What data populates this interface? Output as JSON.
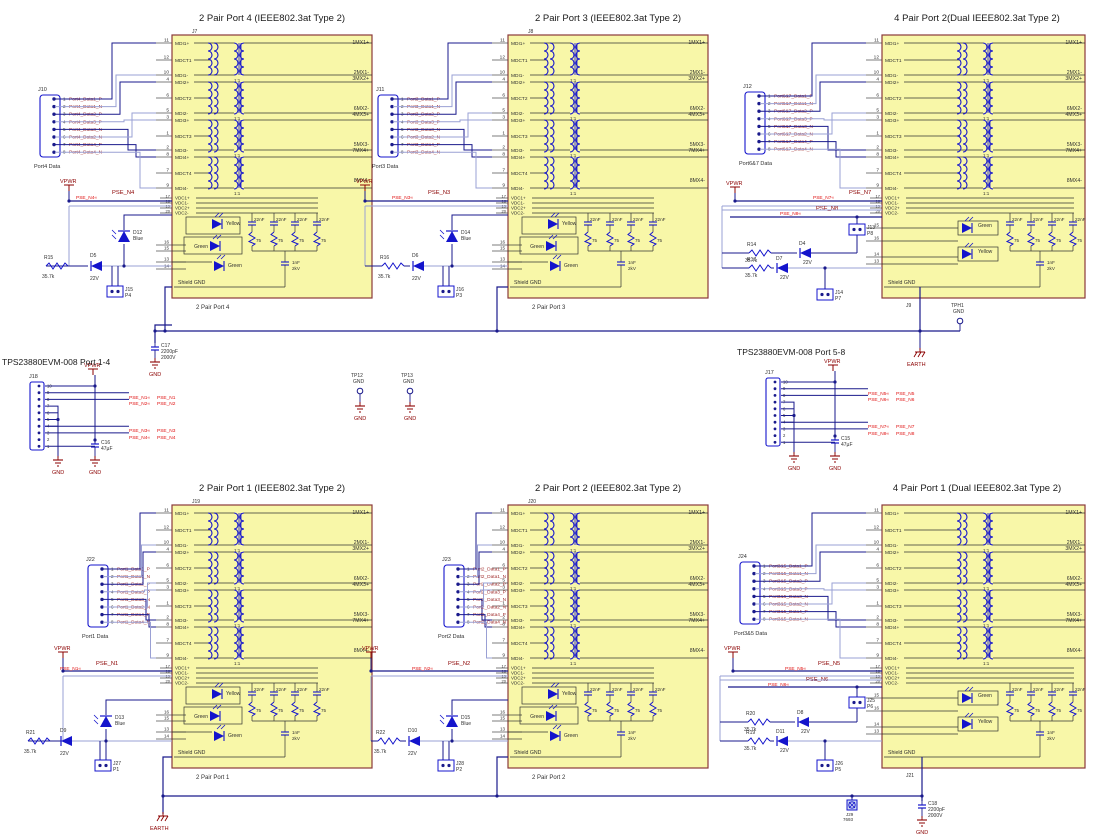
{
  "canvas": {
    "w": 1097,
    "h": 840
  },
  "colors": {
    "block_fill": "#F8F7A8",
    "block_border": "#8B3A3A",
    "wire": "#1A1A8C",
    "wire_light": "#9AA0D4",
    "component": "#1414CC",
    "net_label": "#8B0000",
    "net_flag": "#E01010",
    "text": "#303030",
    "conn_net": "#A33333",
    "power": "#8B0000"
  },
  "shared_block": {
    "pins_left": [
      [
        "11",
        "MDI1+"
      ],
      [
        "12",
        "MDCT1"
      ],
      [
        "10",
        "MDI1-"
      ],
      [
        "4",
        "MDI2+"
      ],
      [
        "6",
        "MDCT2"
      ],
      [
        "5",
        "MDI2-"
      ],
      [
        "3",
        "MDI3+"
      ],
      [
        "1",
        "MDCT3"
      ],
      [
        "2",
        "MDI3-"
      ],
      [
        "8",
        "MDI4+"
      ],
      [
        "7",
        "MDCT4"
      ],
      [
        "9",
        "MDI4-"
      ]
    ],
    "pins_vdc": [
      [
        "17",
        "VDC1+"
      ],
      [
        "18",
        "VDC1-"
      ],
      [
        "19",
        "VDC2+"
      ],
      [
        "20",
        "VDC2-"
      ]
    ],
    "pins_led_2pair": [
      "16",
      "15",
      "13",
      "14"
    ],
    "pins_led_4pair": [
      "15",
      "16",
      "14",
      "13"
    ],
    "labels_right": [
      "1MX1+",
      "2MX1-",
      "3MX2+",
      "6MX2-",
      "4MX3+",
      "5MX3-",
      "7MX4+",
      "8MX4-"
    ],
    "ratio": "1:1",
    "cap_value": "22nF",
    "res_value": "75",
    "hv_cap": [
      "1nF",
      "2kV"
    ],
    "shield": "Shield GND"
  },
  "blocks": [
    {
      "ref": "J7",
      "ref_pos": "top",
      "title": "2 Pair Port 4 (IEEE802.3at Type 2)",
      "caption": "2 Pair Port 4",
      "type": "2pair",
      "x": 172,
      "y": 35,
      "leds": [
        "Yellow",
        "Green",
        "Green"
      ],
      "connector": {
        "ref": "J10",
        "label": "Port4 Data",
        "x": 40,
        "y": 95,
        "pins": [
          "1",
          "2",
          "3",
          "4",
          "5",
          "6",
          "7",
          "8"
        ],
        "nets": [
          "Port4_Data1_P",
          "Port4_Data1_N",
          "Port4_Data2_P",
          "Port4_Data3_P",
          "Port4_Data3_N",
          "Port4_Data2_N",
          "Port4_Data4_P",
          "Port4_Data4_N"
        ]
      },
      "vpwr": {
        "label": "VPWR",
        "x": 60,
        "y": 178
      },
      "pse": [
        {
          "name": "PSE_N4",
          "fx": 76,
          "fy": 199,
          "lx": 112,
          "ly": 194
        }
      ],
      "ext": [
        {
          "kind": "res",
          "ref": "R15",
          "val": "35.7k",
          "x": 46,
          "y": 266
        },
        {
          "kind": "zener",
          "ref": "D5",
          "val": "22V",
          "x": 88,
          "y": 266
        },
        {
          "kind": "bled",
          "ref": "D12",
          "val": "Blue",
          "x": 118,
          "y": 228
        },
        {
          "kind": "hdr",
          "ref": "J15",
          "val": "P4",
          "x": 107,
          "y": 286
        }
      ]
    },
    {
      "ref": "J8",
      "ref_pos": "top",
      "title": "2 Pair Port 3 (IEEE802.3at Type 2)",
      "caption": "2 Pair Port 3",
      "type": "2pair",
      "x": 508,
      "y": 35,
      "leds": [
        "Yellow",
        "Green",
        "Green"
      ],
      "connector": {
        "ref": "J11",
        "label": "Port3 Data",
        "x": 378,
        "y": 95,
        "pins": [
          "1",
          "2",
          "3",
          "4",
          "5",
          "6",
          "7",
          "8"
        ],
        "nets": [
          "Port3_Data1_P",
          "Port3_Data1_N",
          "Port3_Data2_P",
          "Port3_Data3_P",
          "Port3_Data3_N",
          "Port3_Data2_N",
          "Port3_Data4_P",
          "Port3_Data4_N"
        ]
      },
      "vpwr": {
        "label": "VPWR",
        "x": 356,
        "y": 178
      },
      "pse": [
        {
          "name": "PSE_N3",
          "fx": 392,
          "fy": 199,
          "lx": 428,
          "ly": 194
        }
      ],
      "ext": [
        {
          "kind": "res",
          "ref": "R16",
          "val": "35.7k",
          "x": 382,
          "y": 266
        },
        {
          "kind": "zener",
          "ref": "D6",
          "val": "22V",
          "x": 410,
          "y": 266
        },
        {
          "kind": "bled",
          "ref": "D14",
          "val": "Blue",
          "x": 446,
          "y": 228
        },
        {
          "kind": "hdr",
          "ref": "J16",
          "val": "P3",
          "x": 438,
          "y": 286
        }
      ]
    },
    {
      "ref": "J9",
      "ref_pos": "bottom",
      "title": "4 Pair Port 2(Dual IEEE802.3at Type 2)",
      "caption": "",
      "type": "4pair",
      "x": 882,
      "y": 35,
      "leds": [
        "Green",
        "Yellow"
      ],
      "connector": {
        "ref": "J12",
        "label": "Port6&7 Data",
        "x": 745,
        "y": 92,
        "pins": [
          "1",
          "2",
          "3",
          "4",
          "5",
          "6",
          "7",
          "8"
        ],
        "nets": [
          "Port6&7_Data1_P",
          "Port6&7_Data1_N",
          "Port6&7_Data2_P",
          "Port6&7_Data3_P",
          "Port6&7_Data3_N",
          "Port6&7_Data2_N",
          "Port6&7_Data4_P",
          "Port6&7_Data4_N"
        ]
      },
      "vpwr": {
        "label": "VPWR",
        "x": 726,
        "y": 180
      },
      "pse": [
        {
          "name": "PSE_N7",
          "fx": 813,
          "fy": 199,
          "lx": 849,
          "ly": 194
        },
        {
          "name": "PSE_N8",
          "fx": 780,
          "fy": 215,
          "lx": 816,
          "ly": 210
        }
      ],
      "ext": [
        {
          "kind": "res",
          "ref": "R14",
          "val": "35.7k",
          "x": 749,
          "y": 253
        },
        {
          "kind": "zener",
          "ref": "D4",
          "val": "22V",
          "x": 797,
          "y": 253
        },
        {
          "kind": "res",
          "ref": "R17",
          "val": "35.7k",
          "x": 749,
          "y": 268
        },
        {
          "kind": "zener",
          "ref": "D7",
          "val": "22V",
          "x": 774,
          "y": 268
        },
        {
          "kind": "hdr",
          "ref": "J13",
          "val": "P8",
          "x": 849,
          "y": 224
        },
        {
          "kind": "hdr",
          "ref": "J14",
          "val": "P7",
          "x": 817,
          "y": 289
        }
      ]
    },
    {
      "ref": "J19",
      "ref_pos": "top",
      "title": "2 Pair Port 1 (IEEE802.3at Type 2)",
      "caption": "2 Pair Port 1",
      "type": "2pair",
      "x": 172,
      "y": 505,
      "leds": [
        "Yellow",
        "Green",
        "Green"
      ],
      "connector": {
        "ref": "J22",
        "label": "Port1 Data",
        "x": 88,
        "y": 565,
        "pins": [
          "1",
          "2",
          "3",
          "4",
          "5",
          "6",
          "7",
          "8"
        ],
        "nets": [
          "Port1_Data1_P",
          "Port1_Data1_N",
          "Port1_Data2_P",
          "Port1_Data3_P",
          "Port1_Data3_N",
          "Port1_Data2_N",
          "Port1_Data4_P",
          "Port1_Data4_N"
        ]
      },
      "vpwr": {
        "label": "VPWR",
        "x": 54,
        "y": 645
      },
      "pse": [
        {
          "name": "PSE_N1",
          "fx": 60,
          "fy": 670,
          "lx": 96,
          "ly": 665
        }
      ],
      "ext": [
        {
          "kind": "res",
          "ref": "R21",
          "val": "35.7k",
          "x": 28,
          "y": 741
        },
        {
          "kind": "zener",
          "ref": "D9",
          "val": "22V",
          "x": 58,
          "y": 741
        },
        {
          "kind": "bled",
          "ref": "D13",
          "val": "Blue",
          "x": 100,
          "y": 713
        },
        {
          "kind": "hdr",
          "ref": "J27",
          "val": "P1",
          "x": 95,
          "y": 760
        }
      ]
    },
    {
      "ref": "J20",
      "ref_pos": "top",
      "title": "2 Pair Port 2 (IEEE802.3at Type 2)",
      "caption": "2 Pair Port 2",
      "type": "2pair",
      "x": 508,
      "y": 505,
      "leds": [
        "Yellow",
        "Green",
        "Green"
      ],
      "connector": {
        "ref": "J23",
        "label": "Port2 Data",
        "x": 444,
        "y": 565,
        "pins": [
          "1",
          "2",
          "3",
          "4",
          "5",
          "6",
          "7",
          "8"
        ],
        "nets": [
          "Port2_Data1_P",
          "Port2_Data1_N",
          "Port2_Data2_P",
          "Port2_Data3_P",
          "Port2_Data3_N",
          "Port2_Data2_N",
          "Port2_Data4_P",
          "Port2_Data4_N"
        ]
      },
      "vpwr": {
        "label": "VPWR",
        "x": 362,
        "y": 645
      },
      "pse": [
        {
          "name": "PSE_N2",
          "fx": 412,
          "fy": 670,
          "lx": 448,
          "ly": 665
        }
      ],
      "ext": [
        {
          "kind": "res",
          "ref": "R22",
          "val": "35.7k",
          "x": 378,
          "y": 741
        },
        {
          "kind": "zener",
          "ref": "D10",
          "val": "22V",
          "x": 406,
          "y": 741
        },
        {
          "kind": "bled",
          "ref": "D15",
          "val": "Blue",
          "x": 446,
          "y": 713
        },
        {
          "kind": "hdr",
          "ref": "J28",
          "val": "P2",
          "x": 438,
          "y": 760
        }
      ]
    },
    {
      "ref": "J21",
      "ref_pos": "bottom",
      "title": "4 Pair Port 1 (Dual IEEE802.3at Type 2)",
      "caption": "",
      "type": "4pair",
      "x": 882,
      "y": 505,
      "leds": [
        "Green",
        "Yellow"
      ],
      "connector": {
        "ref": "J24",
        "label": "Port3&5 Data",
        "x": 740,
        "y": 562,
        "pins": [
          "1",
          "2",
          "3",
          "4",
          "5",
          "6",
          "7",
          "8"
        ],
        "nets": [
          "Port3&5_Data1_P",
          "Port3&5_Data1_N",
          "Port3&5_Data2_P",
          "Port3&5_Data3_P",
          "Port3&5_Data3_N",
          "Port3&5_Data2_N",
          "Port3&5_Data4_P",
          "Port3&5_Data4_N"
        ]
      },
      "vpwr": {
        "label": "VPWR",
        "x": 724,
        "y": 645
      },
      "pse": [
        {
          "name": "PSE_N5",
          "fx": 785,
          "fy": 670,
          "lx": 818,
          "ly": 665
        },
        {
          "name": "PSE_N6",
          "fx": 768,
          "fy": 686,
          "lx": 806,
          "ly": 681
        }
      ],
      "ext": [
        {
          "kind": "res",
          "ref": "R20",
          "val": "35.7k",
          "x": 748,
          "y": 722
        },
        {
          "kind": "zener",
          "ref": "D8",
          "val": "22V",
          "x": 795,
          "y": 722
        },
        {
          "kind": "res",
          "ref": "R19",
          "val": "35.7k",
          "x": 748,
          "y": 741
        },
        {
          "kind": "zener",
          "ref": "D11",
          "val": "22V",
          "x": 774,
          "y": 741
        },
        {
          "kind": "hdr",
          "ref": "J25",
          "val": "P6",
          "x": 849,
          "y": 697
        },
        {
          "kind": "hdr",
          "ref": "J26",
          "val": "P5",
          "x": 817,
          "y": 760
        }
      ]
    }
  ],
  "sections": {
    "left": {
      "title": "TPS23880EVM-008 Port 1-4",
      "conn_ref": "J18",
      "x": 30,
      "y": 382,
      "pins": [
        "10",
        "9",
        "8",
        "7",
        "6",
        "5",
        "4",
        "3",
        "2",
        "1"
      ],
      "vpwr": "VPWR",
      "nets": [
        {
          "name": "PSE_N1",
          "x": 131,
          "y": 399
        },
        {
          "name": "PSE_N2",
          "x": 131,
          "y": 405
        },
        {
          "name": "PSE_N3",
          "x": 131,
          "y": 432
        },
        {
          "name": "PSE_N4",
          "x": 131,
          "y": 439
        }
      ],
      "cap": {
        "ref": "C16",
        "val": "47µF"
      },
      "gnd_label": "GND"
    },
    "right": {
      "title": "TPS23880EVM-008 Port 5-8",
      "conn_ref": "J17",
      "x": 766,
      "y": 378,
      "pins": [
        "10",
        "9",
        "8",
        "7",
        "6",
        "5",
        "4",
        "3",
        "2",
        "1"
      ],
      "vpwr": "VPWR",
      "nets": [
        {
          "name": "PSE_N5",
          "x": 870,
          "y": 395
        },
        {
          "name": "PSE_N6",
          "x": 870,
          "y": 401
        },
        {
          "name": "PSE_N7",
          "x": 870,
          "y": 428
        },
        {
          "name": "PSE_N8",
          "x": 870,
          "y": 435
        }
      ],
      "cap": {
        "ref": "C15",
        "val": "47µF"
      },
      "gnd_label": "GND"
    },
    "c17": {
      "ref": "C17",
      "val": "2200pF",
      "volt": "2000V",
      "gnd_label": "GND"
    },
    "earth_top": {
      "label": "EARTH"
    }
  },
  "testpoints": [
    {
      "ref": "TP12",
      "sub": "GND",
      "x": 360,
      "y": 391,
      "gnd_label": "GND"
    },
    {
      "ref": "TP13",
      "sub": "GND",
      "x": 410,
      "y": 391,
      "gnd_label": "GND"
    },
    {
      "ref": "TPH1",
      "sub": "GND",
      "x": 960,
      "y": 321,
      "gnd_label": ""
    }
  ],
  "bottom": {
    "earth_left": {
      "label": "EARTH"
    },
    "mount": {
      "ref": "J29",
      "val": "7693"
    },
    "c18": {
      "ref": "C18",
      "val": "2200pF",
      "volt": "2000V",
      "gnd_label": "GND"
    }
  }
}
